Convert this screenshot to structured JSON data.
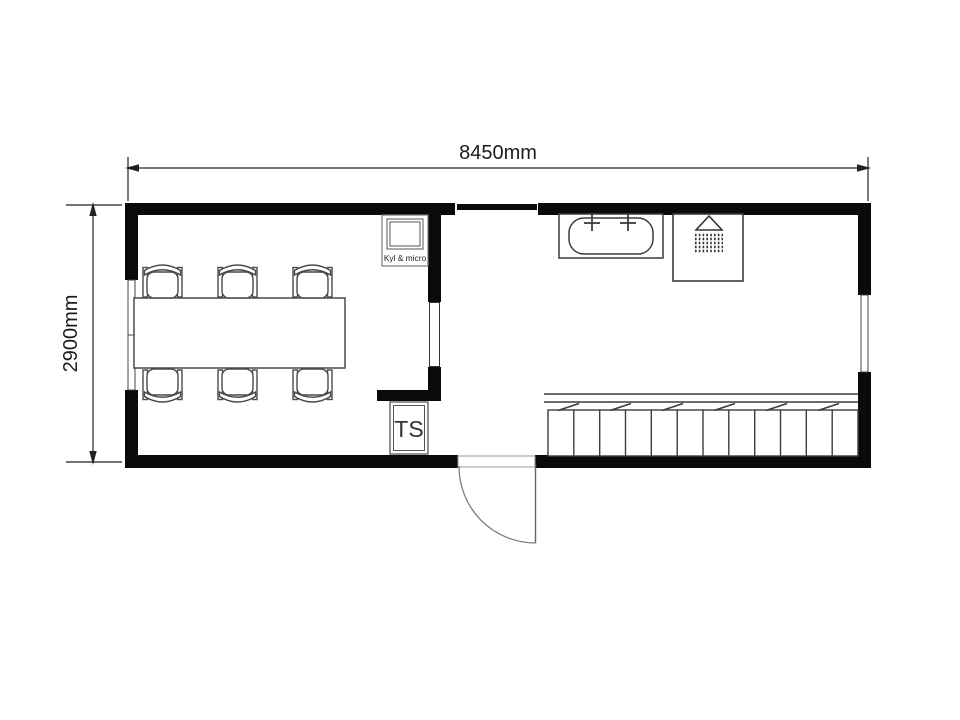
{
  "plan": {
    "dimension_width_label": "8450mm",
    "dimension_height_label": "2900mm",
    "kitchenette_label": "Kyl & micro",
    "toilet_label": "TS",
    "chair_count": 6,
    "locker_compartments": 12,
    "fixtures": [
      "dining-table",
      "chairs",
      "fridge-microwave-unit",
      "toilet-TS",
      "bathtub",
      "shower",
      "locker-bench",
      "entry-door",
      "window-left",
      "window-right",
      "window-top",
      "interior-window"
    ],
    "colors": {
      "wall": "#0a0a0a",
      "fixture_line": "#4a4a4a",
      "dimension_line": "#222222",
      "background": "#ffffff"
    }
  }
}
